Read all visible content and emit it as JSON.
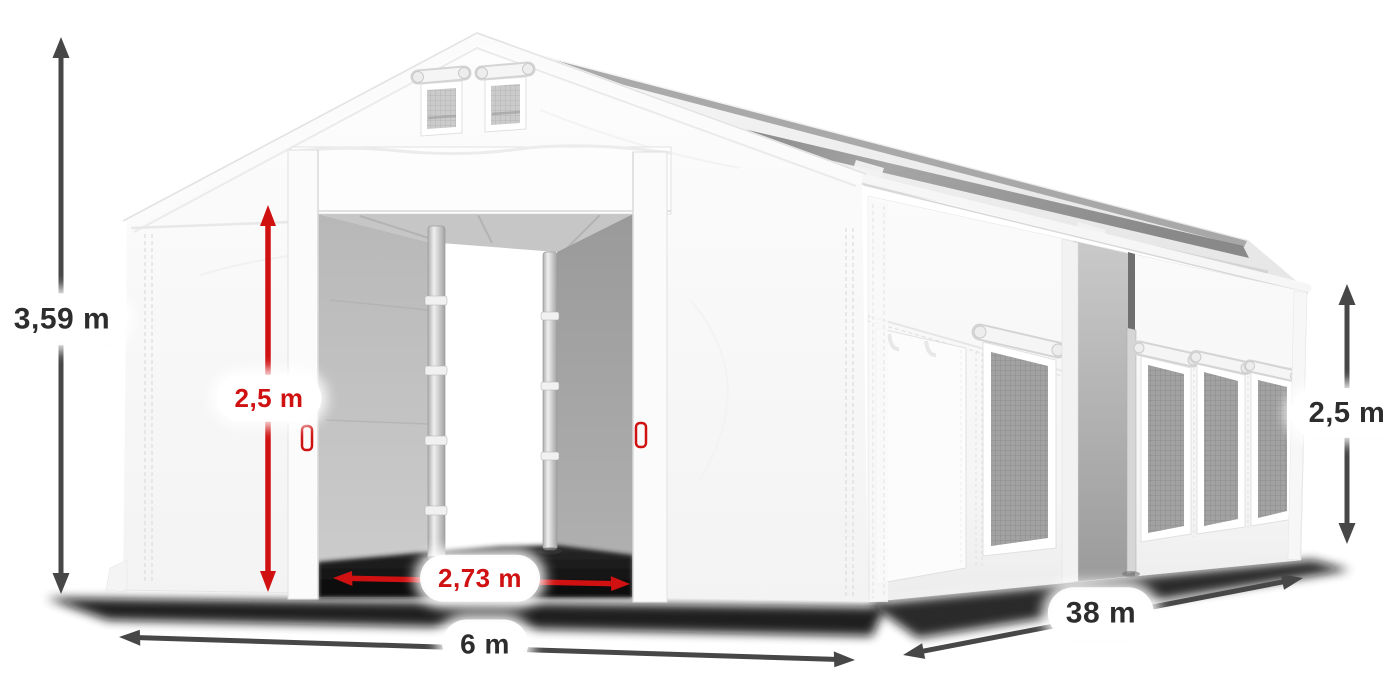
{
  "scene": {
    "description": "3D product render of a white PVC storage tent with open front sliding doors, gable vents, mesh side windows and dimension annotations",
    "background_color": "#ffffff"
  },
  "dimensions": {
    "total_height": {
      "value": "3,59 m",
      "orientation": "vertical",
      "style": "dark"
    },
    "door_height": {
      "value": "2,5 m",
      "orientation": "vertical",
      "style": "red"
    },
    "door_width": {
      "value": "2,73 m",
      "orientation": "horizontal",
      "style": "red"
    },
    "total_width": {
      "value": "6 m",
      "orientation": "horizontal",
      "style": "dark"
    },
    "length": {
      "value": "38 m",
      "orientation": "diagonal",
      "style": "dark"
    },
    "side_height": {
      "value": "2,5 m",
      "orientation": "vertical",
      "style": "dark"
    }
  },
  "colors": {
    "accent_red": "#d01111",
    "arrow_dark": "#474747",
    "label_text_dark": "#2d2d2d",
    "tent_white": "#fafafa",
    "interior_gray": "#ababab",
    "mesh_gray": "#a2a2a2",
    "shadow": "#0b0b0b"
  }
}
